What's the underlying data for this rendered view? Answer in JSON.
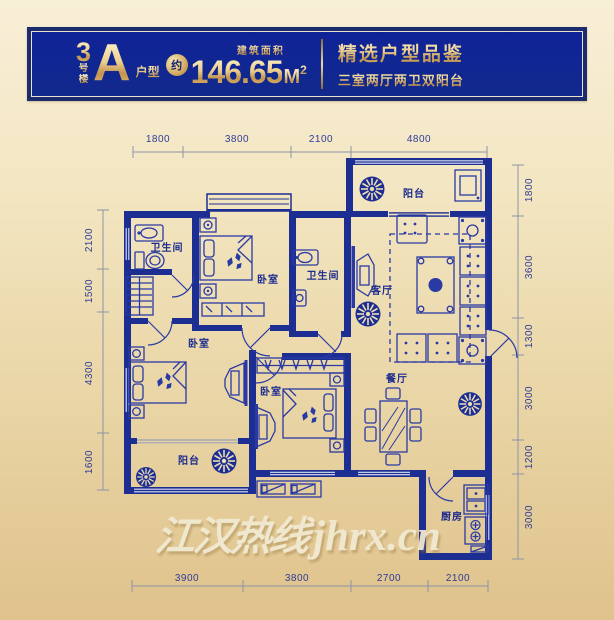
{
  "header": {
    "building_digit": "3",
    "building_char1": "号",
    "building_char2": "楼",
    "unit_letter": "A",
    "unit_type_label": "户型",
    "approx_label": "约",
    "area_value": "146.65",
    "area_unit": "M",
    "area_exponent": "2",
    "area_caption": "建筑面积",
    "tagline_title": "精选户型品鉴",
    "tagline_subtitle": "三室两厅两卫双阳台"
  },
  "floorplan": {
    "rooms": [
      {
        "id": "balcony-north",
        "label": "阳台"
      },
      {
        "id": "bathroom-a",
        "label": "卫生间"
      },
      {
        "id": "bedroom-a",
        "label": "卧室"
      },
      {
        "id": "bathroom-b",
        "label": "卫生间"
      },
      {
        "id": "living-room",
        "label": "客厅"
      },
      {
        "id": "bedroom-b",
        "label": "卧室"
      },
      {
        "id": "balcony-south",
        "label": "阳台"
      },
      {
        "id": "bedroom-c",
        "label": "卧室"
      },
      {
        "id": "dining-room",
        "label": "餐厅"
      },
      {
        "id": "kitchen",
        "label": "厨房"
      }
    ],
    "dimensions_top": [
      "1800",
      "3800",
      "2100",
      "4800"
    ],
    "dimensions_bottom": [
      "3900",
      "3800",
      "2700",
      "2100"
    ],
    "dimensions_left": [
      "2100",
      "1500",
      "4300",
      "1600"
    ],
    "dimensions_right": [
      "1800",
      "3600",
      "1300",
      "3000",
      "1200",
      "3000"
    ]
  },
  "watermark": {
    "text_cn": "江汉热线",
    "text_latin": "jhrx.cn"
  },
  "colors": {
    "wall_navy": "#1d2e92",
    "header_blue": "#12298c",
    "gold": "#dcb267",
    "background_top": "#f8efd8",
    "background_bottom": "#dfc28c"
  }
}
